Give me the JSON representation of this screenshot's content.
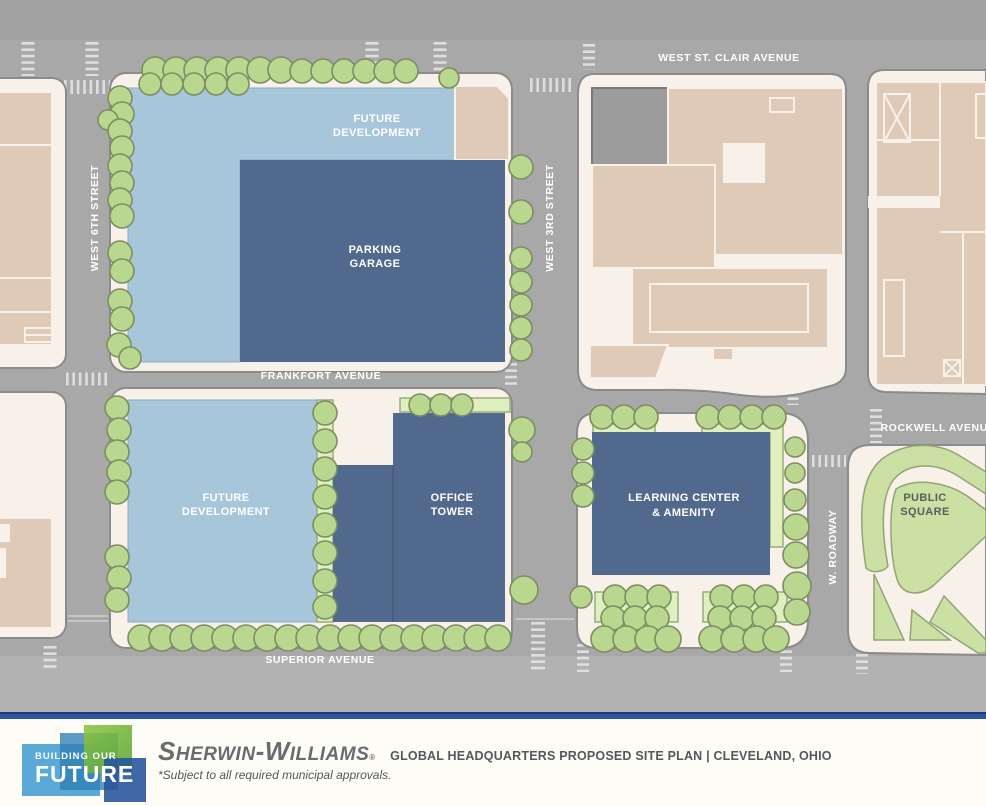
{
  "colors": {
    "street": "#a8a8a8",
    "street_dark": "#a2a2a2",
    "street_light": "#b2b2b2",
    "block": "#f8f1e9",
    "block_stroke": "#8b8b8b",
    "building_tan": "#decab7",
    "building_gray": "#9c9c9c",
    "future_blue": "#a7c6da",
    "hq_blue": "#50698c",
    "tree_fill": "#b9d78e",
    "tree_stroke": "#7c8e61",
    "lawn": "#dff0bf",
    "lawn_stroke": "#9aaa7d",
    "park_green": "#cbe1a4",
    "park_stroke": "#93a377",
    "park_label": "#5b5c5e",
    "footer_bar": "#2b57a5",
    "footer_bar_dark": "#1e3a75",
    "logo_lightblue": "#5aa9d6",
    "logo_teal": "#2f7fb5",
    "logo_green": "#5aa336",
    "logo_navy": "#27539b",
    "brand_gray": "#6a6b6e",
    "title_gray": "#56575a"
  },
  "map": {
    "streets": {
      "west_st_clair": "WEST ST. CLAIR AVENUE",
      "west_6th": "WEST 6TH STREET",
      "west_3rd": "WEST 3RD STREET",
      "frankfort": "FRANKFORT AVENUE",
      "rockwell": "ROCKWELL AVENUE",
      "superior": "SUPERIOR AVENUE",
      "w_roadway": "W. ROADWAY"
    },
    "sites": {
      "future_development_north": {
        "l1": "FUTURE",
        "l2": "DEVELOPMENT"
      },
      "parking_garage": {
        "l1": "PARKING",
        "l2": "GARAGE"
      },
      "future_development_south": {
        "l1": "FUTURE",
        "l2": "DEVELOPMENT"
      },
      "office_tower": {
        "l1": "OFFICE",
        "l2": "TOWER"
      },
      "learning_center": {
        "l1": "LEARNING CENTER",
        "l2": "& AMENITY"
      },
      "public_square": {
        "l1": "PUBLIC",
        "l2": "SQUARE"
      }
    }
  },
  "footer": {
    "logo": {
      "line1": "BUILDING OUR",
      "line2": "FUTURE"
    },
    "brand": {
      "s1": "S",
      "s2": "HERWIN",
      "dash": "-",
      "w1": "W",
      "w2": "ILLIAMS",
      "reg": "®"
    },
    "title": "GLOBAL HEADQUARTERS PROPOSED SITE PLAN | CLEVELAND, OHIO",
    "disclaimer": "*Subject to all required municipal approvals."
  }
}
